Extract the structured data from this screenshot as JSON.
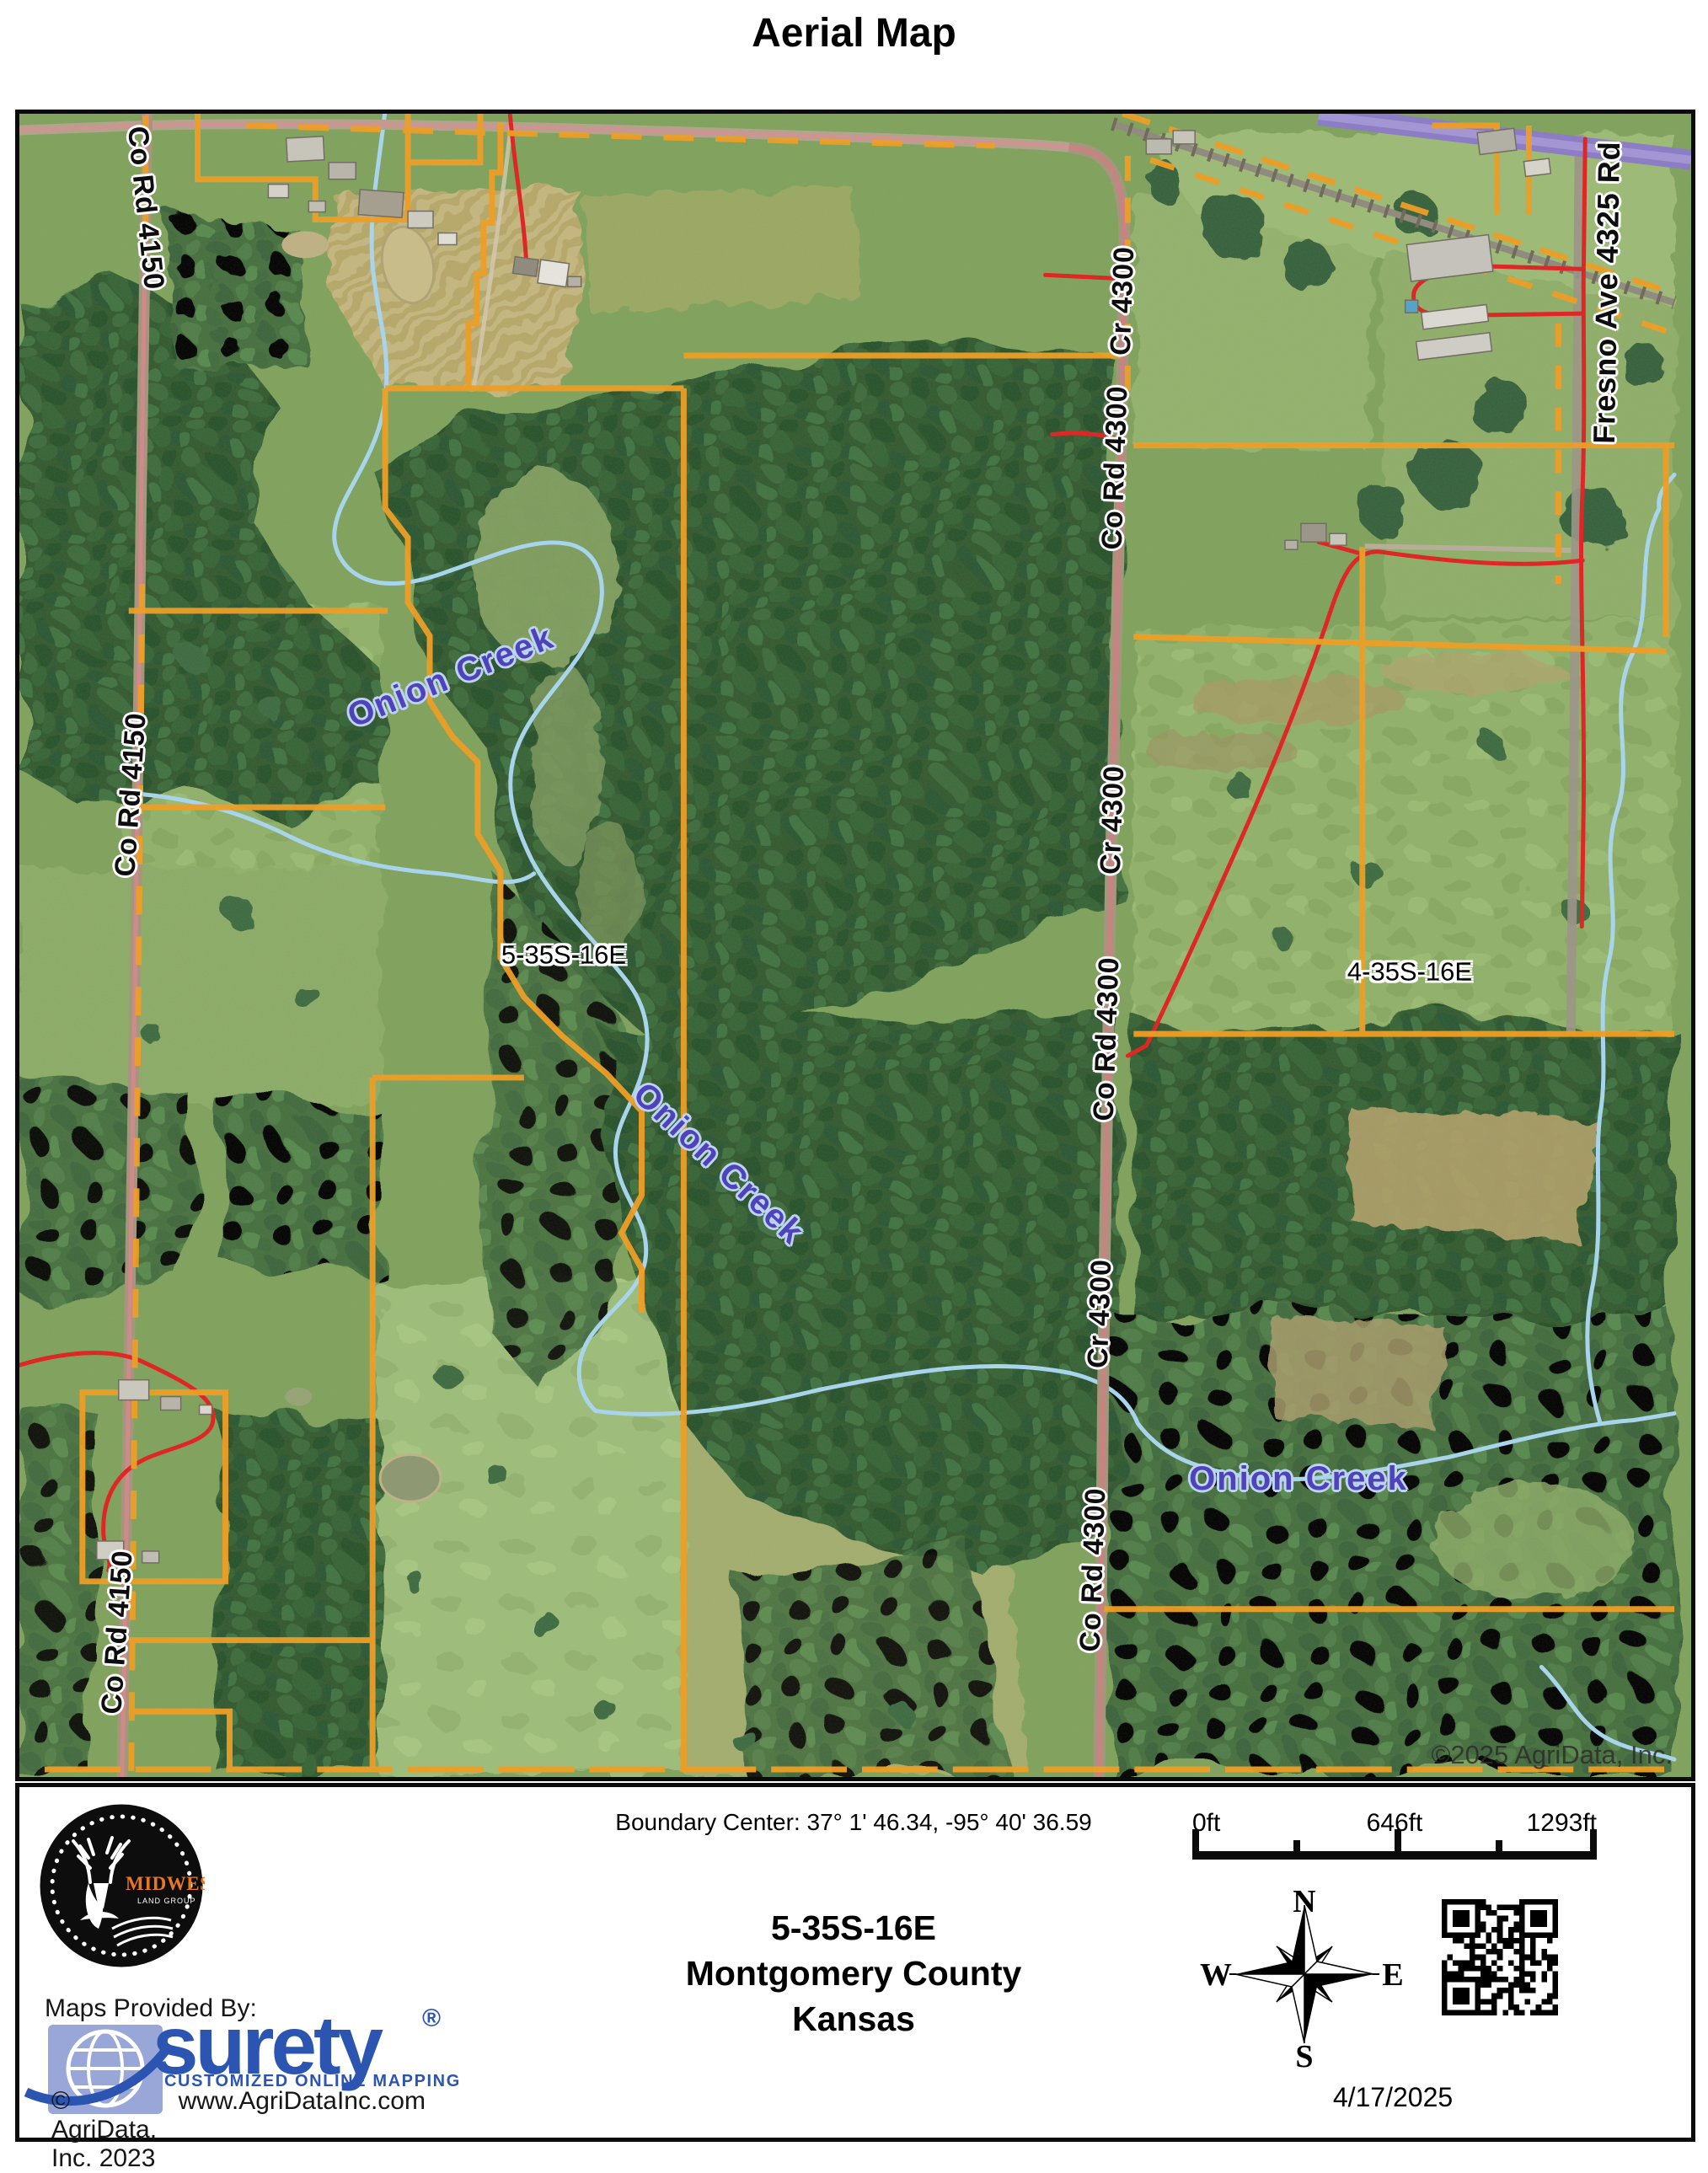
{
  "title": "Aerial Map",
  "map": {
    "labels": {
      "co_rd_4150_top": "Co Rd 4150",
      "co_rd_4150_mid": "Co Rd 4150",
      "co_rd_4150_bottom": "Co Rd 4150",
      "cr_4300_top": "Cr 4300",
      "co_rd_4300_top": "Co Rd 4300",
      "cr_4300_mid": "Cr 4300",
      "co_rd_4300_mid": "Co Rd 4300",
      "cr_4300_bottom": "Cr 4300",
      "co_rd_4300_bottom": "Co Rd 4300",
      "fresno_ave": "Fresno Ave 4325 Rd",
      "onion_creek_upper": "Onion Creek",
      "onion_creek_middle": "Onion Creek",
      "onion_creek_lower": "Onion Creek",
      "parcel_5_35s_16e": "5-35S-16E",
      "parcel_4_35s_16e": "4-35S-16E",
      "copyright": "©2025 AgriData, Inc."
    },
    "colors": {
      "boundary_orange": "#f09d20",
      "creek_blue": "#a8d6ef",
      "creek_label_purple": "#4f43bb",
      "trail_red": "#e01f1f",
      "highway_purple": "#8a7ac6"
    }
  },
  "footer": {
    "boundary_center": "Boundary Center: 37° 1' 46.34,  -95° 40' 36.59",
    "section": "5-35S-16E",
    "county": "Montgomery County",
    "state": "Kansas",
    "maps_provided_by": "Maps Provided By:",
    "midwest_logo": {
      "name": "MIDWEST",
      "subtitle": "LAND GROUP"
    },
    "surety": {
      "name": "surety",
      "reg": "®",
      "tagline": "CUSTOMIZED ONLINE MAPPING",
      "copyright": "© AgriData, Inc. 2023",
      "url": "www.AgriDataInc.com",
      "brand_blue": "#2c55b2"
    },
    "scale_bar": {
      "start": "0ft",
      "middle": "646ft",
      "end": "1293ft"
    },
    "compass": {
      "n": "N",
      "s": "S",
      "e": "E",
      "w": "W"
    },
    "date": "4/17/2025"
  }
}
